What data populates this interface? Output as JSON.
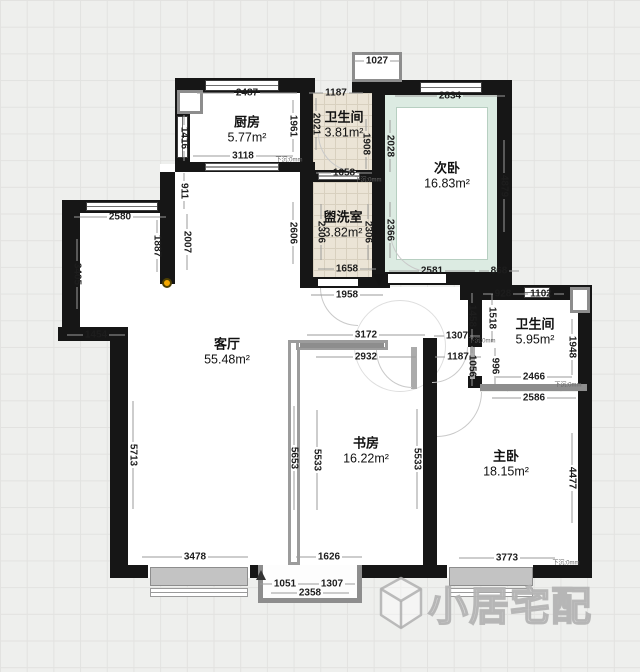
{
  "plan": {
    "type": "floorplan",
    "unit": "mm",
    "watermark_text": "小居宅配"
  },
  "colors": {
    "wall": "#161616",
    "tile_floor": "#ebe4d6",
    "balcony_tint": "#dcebe2",
    "grid_background": "#eeefed",
    "pillar_dot": "#f4a700",
    "window_gray": "#c3c3c3"
  },
  "rooms": [
    {
      "id": "kitchen",
      "name": "厨房",
      "area": "5.77m²"
    },
    {
      "id": "bath1",
      "name": "卫生间",
      "area": "3.81m²"
    },
    {
      "id": "bedroom2",
      "name": "次卧",
      "area": "16.83m²"
    },
    {
      "id": "laundry",
      "name": "盥洗室",
      "area": "3.82m²"
    },
    {
      "id": "living",
      "name": "客厅",
      "area": "55.48m²"
    },
    {
      "id": "bath2",
      "name": "卫生间",
      "area": "5.95m²"
    },
    {
      "id": "study",
      "name": "书房",
      "area": "16.22m²"
    },
    {
      "id": "master",
      "name": "主卧",
      "area": "18.15m²"
    }
  ],
  "dims": {
    "top-duct-w": "1027",
    "kitchen-top": "2487",
    "bath1-top": "1187",
    "bed2-top": "2834",
    "kitchen-bottom": "3118",
    "bath1-bottom": "1658",
    "dining-top": "2580",
    "laundry-bottom": "1658",
    "laundry-opening": "1958",
    "bed2-bottom-left": "2581",
    "bed2-bottom-right": "868",
    "bath2-top-left": "928",
    "bath2-top-right": "1102",
    "dining-step": "1454",
    "study-top-outer": "3172",
    "hall-top": "1307",
    "study-top-inner": "2932",
    "hall-inner": "1187",
    "bath2-bottom-inner": "2466",
    "master-top": "2586",
    "living-bottom": "3478",
    "study-bottom": "1626",
    "master-bottom": "3773",
    "entry-left": "1051",
    "entry-right": "1307",
    "entry-total": "2358",
    "kitchen-left": "1416",
    "kitchen-right": "1961",
    "bath1-left": "2021",
    "bath1-right": "1908",
    "bed2-left": "2028",
    "bed2-right": "4879",
    "stub-left": "911",
    "laundry-left-outer": "2606",
    "laundry-left-inner": "2306",
    "laundry-right-inner": "2306",
    "bed2-left-inner": "2366",
    "stub-mid": "1887",
    "stub-right": "2007",
    "dining-left": "3405",
    "bath2-left-outer": "1458",
    "bath2-left-inner": "1518",
    "bath2-right": "1948",
    "bath2-left-lower": "1056",
    "bath2-door": "996",
    "living-left": "5713",
    "study-left-outer": "5653",
    "study-left-inner": "5533",
    "study-right-inner": "5533",
    "master-right": "4477"
  },
  "notes": {
    "sunken": "下沉:0mm"
  }
}
